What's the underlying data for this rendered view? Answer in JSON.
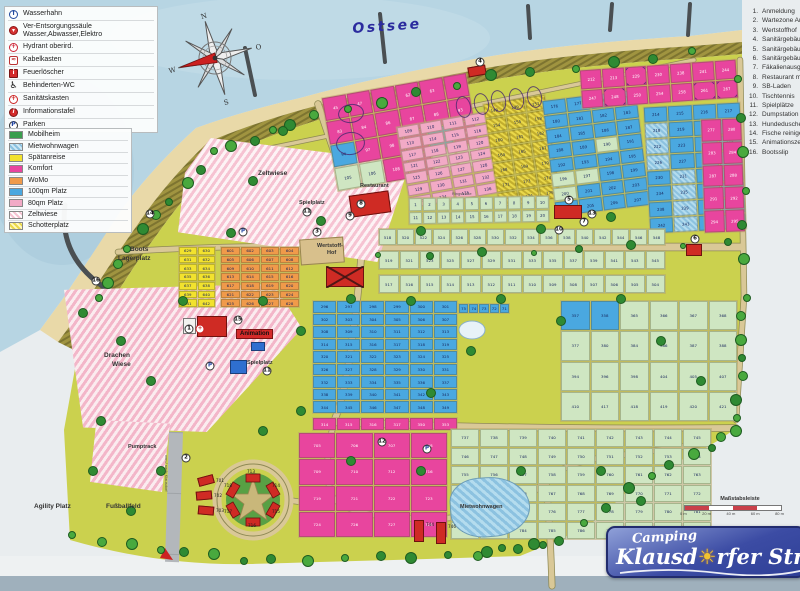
{
  "labels_meta": {
    "sea": "Ostsee"
  },
  "logo": {
    "line1": "Camping",
    "line2_pre": "Klausd",
    "sun_glyph": "☀",
    "line2_post": "rfer Strand"
  },
  "scale": {
    "label": "Maßstabsleiste",
    "ticks": [
      "0 m",
      "20 m",
      "40 m",
      "60 m",
      "80 m"
    ]
  },
  "compass": {
    "n": "N",
    "e": "O",
    "s": "S",
    "w": "W"
  },
  "colors": {
    "sea": "#b7d5e3",
    "beach": "#e9d9a8",
    "dune": "#a09440",
    "ground": "#cbd14e",
    "road": "#d9c897",
    "accent_red": "#cf2b24",
    "logo_blue": "#2e3f96"
  },
  "symbols_legend": [
    {
      "icon": "tap-icon",
      "cls": "ic-tap",
      "glyph": "T",
      "label": "Wasserhahn"
    },
    {
      "icon": "supply-column-icon",
      "cls": "ic-ver",
      "glyph": "▾",
      "label": "Ver-Entsorgungssäule Wasser,Abwasser,Elektro",
      "twoline": true
    },
    {
      "icon": "hydrant-icon",
      "cls": "ic-hyd",
      "glyph": "+",
      "label": "Hydrant oberird."
    },
    {
      "icon": "cable-box-icon",
      "cls": "ic-kab",
      "glyph": "≈",
      "label": "Kabelkasten"
    },
    {
      "icon": "fire-extinguisher-icon",
      "cls": "ic-feu",
      "glyph": "i",
      "label": "Feuerlöscher"
    },
    {
      "icon": "wheelchair-icon",
      "cls": "ic-wc",
      "glyph": "♿",
      "label": "Behinderten-WC"
    },
    {
      "icon": "first-aid-icon",
      "cls": "ic-san",
      "glyph": "+",
      "label": "Sanitätskasten"
    },
    {
      "icon": "info-board-icon",
      "cls": "ic-inf",
      "glyph": "i",
      "label": "Informationstafel"
    },
    {
      "icon": "parking-icon",
      "cls": "ic-park",
      "glyph": "P",
      "label": "Parken"
    }
  ],
  "color_legend": [
    {
      "label": "Mobilheim",
      "css": "solid",
      "hex": "#3a9e4e"
    },
    {
      "label": "Mietwohnwagen",
      "css": "hatch-blue",
      "hex": "#8cc2e0"
    },
    {
      "label": "Spätanreise",
      "css": "solid",
      "hex": "#f2e22e"
    },
    {
      "label": "Komfort",
      "css": "solid",
      "hex": "#e8459e"
    },
    {
      "label": "WoMo",
      "css": "solid",
      "hex": "#f09a4a"
    },
    {
      "label": "100qm Platz",
      "css": "solid",
      "hex": "#4aa8e0"
    },
    {
      "label": "80qm Platz",
      "css": "solid",
      "hex": "#f2aac6"
    },
    {
      "label": "Zeltwiese",
      "css": "hatch-pink",
      "hex": "#f6c3d2"
    },
    {
      "label": "Schotterplatz",
      "css": "hatch-yellow",
      "hex": "#ead84a"
    }
  ],
  "poi_list": [
    {
      "n": "1.",
      "label": "Anmeldung"
    },
    {
      "n": "2.",
      "label": "Wartezone Anreise"
    },
    {
      "n": "3.",
      "label": "Wertstoffhof"
    },
    {
      "n": "4.",
      "label": "Sanitärgebäude"
    },
    {
      "n": "5.",
      "label": "Sanitärgebäude"
    },
    {
      "n": "6.",
      "label": "Sanitärgebäude"
    },
    {
      "n": "7.",
      "label": "Fäkalienausguss"
    },
    {
      "n": "8.",
      "label": "Restaurant mit Imbiss"
    },
    {
      "n": "9.",
      "label": "SB-Laden"
    },
    {
      "n": "10.",
      "label": "Tischtennis"
    },
    {
      "n": "11.",
      "label": "Spielplätze"
    },
    {
      "n": "12.",
      "label": "Dumpstation für Womo"
    },
    {
      "n": "13.",
      "label": "Hundedusche"
    },
    {
      "n": "14.",
      "label": "Fische reinigen"
    },
    {
      "n": "15.",
      "label": "Animationszelt"
    },
    {
      "n": "16.",
      "label": "Bootsslip"
    }
  ],
  "area_labels": [
    {
      "text": "Ostsee",
      "x": 352,
      "y": 22,
      "cls": "lbl-sea",
      "rot": -4
    },
    {
      "text": "Zeltwiese",
      "x": 258,
      "y": 170,
      "cls": "lbl-area"
    },
    {
      "text": "Drachen",
      "x": 104,
      "y": 352,
      "cls": "lbl-area"
    },
    {
      "text": "Wiese",
      "x": 112,
      "y": 361,
      "cls": "lbl-area"
    },
    {
      "text": "Boots",
      "x": 130,
      "y": 246,
      "cls": "lbl-area"
    },
    {
      "text": "Lagerplatz",
      "x": 118,
      "y": 255,
      "cls": "lbl-area"
    },
    {
      "text": "Agility Platz",
      "x": 34,
      "y": 503,
      "cls": "lbl-area"
    },
    {
      "text": "Fußballfeld",
      "x": 106,
      "y": 503,
      "cls": "lbl-area"
    },
    {
      "text": "Pumptrack",
      "x": 128,
      "y": 444,
      "cls": "lbl-area-sm"
    },
    {
      "text": "Restaurant",
      "x": 360,
      "y": 183,
      "cls": "lbl-area-sm"
    },
    {
      "text": "Animation",
      "x": 236,
      "y": 329,
      "cls": "lbl-redbg"
    },
    {
      "text": "Spielplatz",
      "x": 247,
      "y": 360,
      "cls": "lbl-area-sm"
    },
    {
      "text": "Spielplatz",
      "x": 299,
      "y": 200,
      "cls": "lbl-area-sm"
    },
    {
      "text": "Wertstoff-",
      "x": 317,
      "y": 243,
      "cls": "lbl-area-sm"
    },
    {
      "text": "Hof",
      "x": 327,
      "y": 250,
      "cls": "lbl-area-sm"
    },
    {
      "text": "Mietwohnwagen",
      "x": 460,
      "y": 504,
      "cls": "lbl-area-sm"
    },
    {
      "text": "Ringstraße",
      "x": 452,
      "y": 192,
      "cls": "lbl-road"
    },
    {
      "text": "von / nach Klausdorf",
      "x": 168,
      "y": 455,
      "cls": "lbl-road",
      "rot": 90
    },
    {
      "text": "713",
      "x": 247,
      "y": 470,
      "cls": "lbl-plot"
    },
    {
      "text": "714",
      "x": 272,
      "y": 484,
      "cls": "lbl-plot"
    },
    {
      "text": "715",
      "x": 272,
      "y": 510,
      "cls": "lbl-plot"
    },
    {
      "text": "716",
      "x": 248,
      "y": 524,
      "cls": "lbl-plot"
    },
    {
      "text": "717",
      "x": 224,
      "y": 510,
      "cls": "lbl-plot"
    },
    {
      "text": "718",
      "x": 224,
      "y": 484,
      "cls": "lbl-plot"
    }
  ],
  "zones": [
    {
      "name": "spaetanreise-grid",
      "x": 178,
      "y": 246,
      "w": 38,
      "h": 62,
      "rot": 0,
      "cols": 2,
      "rows": 7,
      "cls": "c-yel",
      "nums": {
        "list": [
          629,
          630,
          631,
          632,
          633,
          634,
          635,
          636,
          637,
          638,
          639,
          640,
          641,
          642
        ]
      }
    },
    {
      "name": "womo-grid",
      "x": 220,
      "y": 246,
      "w": 80,
      "h": 62,
      "rot": 0,
      "cols": 4,
      "rows": 7,
      "cls": "c-or",
      "nums": {
        "from": 601,
        "to": 628
      }
    },
    {
      "name": "komfort-top",
      "x": 328,
      "y": 84,
      "w": 148,
      "h": 96,
      "rot": -10,
      "cols": 6,
      "rows": 4,
      "cls": "c-mag",
      "nums": {
        "list": [
          45,
          47,
          61,
          62,
          63,
          82,
          83,
          84,
          86,
          87,
          88,
          93,
          94,
          97,
          98,
          99,
          100,
          104,
          105,
          106,
          108,
          109,
          110,
          111
        ]
      },
      "mixed": {
        "94": "c-blue",
        "100": "c-blue",
        "105": "c-grn",
        "106": "c-grn",
        "110": "c-grn",
        "111": "c-grn"
      }
    },
    {
      "name": "pitch80-grid",
      "x": 402,
      "y": 118,
      "w": 92,
      "h": 84,
      "rot": -10,
      "cols": 4,
      "rows": 7,
      "cls": "c-pink",
      "nums": {
        "from": 109,
        "to": 136
      }
    },
    {
      "name": "schotter-grid",
      "x": 490,
      "y": 98,
      "w": 64,
      "h": 106,
      "rot": -9,
      "cols": 3,
      "rows": 7,
      "cls": "c-schot",
      "nums": {
        "list": [
          148,
          149,
          151,
          154,
          155,
          158,
          160,
          161,
          162,
          164,
          165,
          167,
          168,
          169,
          170,
          171,
          173,
          174,
          175,
          176,
          179
        ]
      }
    },
    {
      "name": "pitch100-a",
      "x": 548,
      "y": 94,
      "w": 96,
      "h": 118,
      "rot": -7,
      "cols": 4,
      "rows": 8,
      "cls": "c-blue",
      "nums": {
        "from": 176,
        "to": 207
      },
      "mixed": {
        "190": "c-grn",
        "196": "c-grn",
        "197": "c-grn",
        "200": "c-grn"
      }
    },
    {
      "name": "komfort-topright",
      "x": 580,
      "y": 64,
      "w": 158,
      "h": 40,
      "rot": -4,
      "cols": 7,
      "rows": 2,
      "cls": "c-mag",
      "nums": {
        "list": [
          212,
          213,
          229,
          230,
          238,
          241,
          244,
          247,
          248,
          250,
          254,
          258,
          261,
          267
        ]
      },
      "circled": [
        229,
        248,
        261,
        267
      ]
    },
    {
      "name": "pitch100-b",
      "x": 646,
      "y": 104,
      "w": 98,
      "h": 128,
      "rot": -3,
      "cols": 4,
      "rows": 8,
      "cls": "c-blue",
      "nums": {
        "from": 214,
        "to": 245
      },
      "mixed": {
        "218": "c-mww",
        "222": "c-mww",
        "226": "c-mww",
        "231": "c-mww",
        "235": "c-mww",
        "239": "c-mww",
        "243": "c-mww"
      }
    },
    {
      "name": "komfort-right",
      "x": 702,
      "y": 118,
      "w": 42,
      "h": 115,
      "rot": -2,
      "cols": 2,
      "rows": 5,
      "cls": "c-mag",
      "nums": {
        "list": [
          277,
          280,
          283,
          284,
          287,
          288,
          291,
          292,
          294,
          295
        ]
      }
    },
    {
      "name": "mobil-row-1-20",
      "x": 408,
      "y": 196,
      "w": 142,
      "h": 28,
      "rot": -1,
      "cols": 10,
      "rows": 2,
      "cls": "c-grn",
      "nums": {
        "from": 1,
        "to": 20
      }
    },
    {
      "name": "mobil-row-518",
      "x": 378,
      "y": 228,
      "w": 288,
      "h": 18,
      "rot": 0,
      "cols": 16,
      "rows": 1,
      "cls": "c-grn",
      "nums": {
        "list": [
          518,
          520,
          522,
          524,
          526,
          528,
          530,
          532,
          534,
          536,
          538,
          540,
          542,
          544,
          546,
          548
        ]
      }
    },
    {
      "name": "mobil-row-519",
      "x": 378,
      "y": 250,
      "w": 288,
      "h": 20,
      "rot": 0,
      "cols": 14,
      "rows": 1,
      "cls": "c-grn",
      "nums": {
        "list": [
          519,
          521,
          523,
          525,
          527,
          529,
          531,
          533,
          535,
          537,
          539,
          541,
          543,
          545
        ]
      }
    },
    {
      "name": "mobil-row-513",
      "x": 378,
      "y": 274,
      "w": 288,
      "h": 20,
      "rot": 0,
      "cols": 14,
      "rows": 1,
      "cls": "c-grn",
      "nums": {
        "list": [
          517,
          516,
          515,
          514,
          513,
          512,
          511,
          510,
          509,
          508,
          507,
          506,
          505,
          504
        ]
      }
    },
    {
      "name": "mobil-right-block",
      "x": 560,
      "y": 300,
      "w": 178,
      "h": 122,
      "rot": 0,
      "cols": 6,
      "rows": 4,
      "cls": "c-grn",
      "nums": {
        "list": [
          357,
          358,
          365,
          366,
          367,
          368,
          377,
          380,
          384,
          386,
          387,
          388,
          394,
          396,
          398,
          404,
          405,
          407,
          410,
          417,
          418,
          419,
          420,
          421
        ]
      },
      "mixed": {
        "357": "c-blue",
        "358": "c-blue"
      }
    },
    {
      "name": "pitch100-center",
      "x": 312,
      "y": 300,
      "w": 146,
      "h": 114,
      "rot": 0,
      "cols": 6,
      "rows": 9,
      "cls": "c-blue",
      "nums": {
        "from": 296,
        "to": 349
      }
    },
    {
      "name": "komfort-center-row",
      "x": 312,
      "y": 417,
      "w": 146,
      "h": 14,
      "rot": 0,
      "cols": 6,
      "rows": 1,
      "cls": "c-mag",
      "nums": {
        "list": [
          314,
          315,
          316,
          317,
          350,
          353
        ]
      }
    },
    {
      "name": "blue-small-row",
      "x": 458,
      "y": 303,
      "w": 52,
      "h": 11,
      "rot": 0,
      "cols": 5,
      "rows": 1,
      "cls": "c-blue",
      "nums": {
        "list": [
          75,
          74,
          73,
          72,
          71
        ]
      }
    },
    {
      "name": "komfort-southwest",
      "x": 298,
      "y": 432,
      "w": 150,
      "h": 106,
      "rot": 0,
      "cols": 4,
      "rows": 4,
      "cls": "c-mag",
      "nums": {
        "list": [
          705,
          706,
          707,
          708,
          709,
          710,
          712,
          716,
          719,
          721,
          722,
          723,
          724,
          726,
          727,
          728
        ]
      }
    },
    {
      "name": "mobil-south",
      "x": 450,
      "y": 428,
      "w": 262,
      "h": 112,
      "rot": 0,
      "cols": 9,
      "rows": 6,
      "cls": "c-grn",
      "nums": {
        "from": 737,
        "to": 790
      }
    }
  ],
  "buildings": [
    {
      "name": "restaurant-building",
      "x": 350,
      "y": 193,
      "w": 40,
      "h": 22,
      "rot": -8,
      "cls": "bld-red"
    },
    {
      "name": "workshop-building-crossed",
      "x": 326,
      "y": 267,
      "w": 38,
      "h": 20,
      "rot": 0,
      "cls": "bld-red"
    },
    {
      "name": "reception-building",
      "x": 183,
      "y": 318,
      "w": 13,
      "h": 16,
      "rot": 0,
      "cls": "bld-white"
    },
    {
      "name": "animation-building",
      "x": 197,
      "y": 316,
      "w": 30,
      "h": 21,
      "rot": 0,
      "cls": "bld-red"
    },
    {
      "name": "sanitary-mid-building",
      "x": 554,
      "y": 205,
      "w": 28,
      "h": 14,
      "rot": 0,
      "cls": "bld-red"
    },
    {
      "name": "sanitary-top-building",
      "x": 468,
      "y": 66,
      "w": 18,
      "h": 10,
      "rot": -10,
      "cls": "bld-red"
    },
    {
      "name": "sanitary-right-building",
      "x": 686,
      "y": 244,
      "w": 16,
      "h": 12,
      "rot": 0,
      "cls": "bld-red"
    },
    {
      "name": "playground-equipment",
      "x": 230,
      "y": 360,
      "w": 17,
      "h": 14,
      "rot": 0,
      "cls": "bld-blue"
    },
    {
      "name": "playground-equipment-2",
      "x": 251,
      "y": 342,
      "w": 14,
      "h": 9,
      "rot": 0,
      "cls": "bld-blue"
    },
    {
      "name": "rental-house",
      "x": 198,
      "y": 476,
      "w": 16,
      "h": 9,
      "rot": -15,
      "cls": "bld-red",
      "label": "701"
    },
    {
      "name": "rental-house",
      "x": 196,
      "y": 491,
      "w": 16,
      "h": 9,
      "rot": -5,
      "cls": "bld-red",
      "label": "702"
    },
    {
      "name": "rental-house",
      "x": 198,
      "y": 506,
      "w": 16,
      "h": 9,
      "rot": 5,
      "cls": "bld-red",
      "label": "703"
    },
    {
      "name": "rental-house",
      "x": 414,
      "y": 520,
      "w": 10,
      "h": 22,
      "rot": 0,
      "cls": "bld-red",
      "label": "744"
    },
    {
      "name": "rental-house",
      "x": 436,
      "y": 522,
      "w": 10,
      "h": 22,
      "rot": 0,
      "cls": "bld-red",
      "label": "746"
    },
    {
      "name": "wertstoffhof-yard",
      "x": 300,
      "y": 238,
      "w": 44,
      "h": 26,
      "rot": -4,
      "cls": "bld-tan"
    }
  ],
  "badges": [
    {
      "n": "1",
      "x": 189,
      "y": 329
    },
    {
      "n": "+",
      "x": 200,
      "y": 329,
      "cls": "b-red"
    },
    {
      "n": "2",
      "x": 186,
      "y": 458
    },
    {
      "n": "3",
      "x": 317,
      "y": 232
    },
    {
      "n": "4",
      "x": 480,
      "y": 62
    },
    {
      "n": "5",
      "x": 569,
      "y": 200
    },
    {
      "n": "6",
      "x": 695,
      "y": 239
    },
    {
      "n": "7",
      "x": 584,
      "y": 222
    },
    {
      "n": "8",
      "x": 361,
      "y": 204
    },
    {
      "n": "9",
      "x": 350,
      "y": 216
    },
    {
      "n": "10",
      "x": 559,
      "y": 230
    },
    {
      "n": "11",
      "x": 267,
      "y": 371
    },
    {
      "n": "11",
      "x": 307,
      "y": 212
    },
    {
      "n": "12",
      "x": 382,
      "y": 442
    },
    {
      "n": "13",
      "x": 592,
      "y": 214
    },
    {
      "n": "14",
      "x": 150,
      "y": 214
    },
    {
      "n": "15",
      "x": 238,
      "y": 320
    },
    {
      "n": "16",
      "x": 96,
      "y": 281
    },
    {
      "n": "P",
      "x": 210,
      "y": 366,
      "cls": "b-p"
    },
    {
      "n": "P",
      "x": 243,
      "y": 232,
      "cls": "b-p"
    },
    {
      "n": "P",
      "x": 427,
      "y": 449,
      "cls": "b-p"
    }
  ],
  "pen_marks": [
    {
      "t": "o",
      "x": 456,
      "y": 96,
      "w": 13,
      "h": 20,
      "r": -12
    },
    {
      "t": "o",
      "x": 474,
      "y": 93,
      "w": 13,
      "h": 20,
      "r": -12
    },
    {
      "t": "o",
      "x": 491,
      "y": 90,
      "w": 13,
      "h": 20,
      "r": -12
    },
    {
      "t": "o",
      "x": 509,
      "y": 88,
      "w": 13,
      "h": 20,
      "r": -12
    },
    {
      "t": "o",
      "x": 527,
      "y": 86,
      "w": 13,
      "h": 20,
      "r": -12
    },
    {
      "t": "o",
      "x": 338,
      "y": 104,
      "w": 24,
      "h": 17,
      "r": -8
    },
    {
      "t": "o",
      "x": 336,
      "y": 132,
      "w": 27,
      "h": 21,
      "r": -8
    },
    {
      "t": "x",
      "x": 326,
      "y": 266,
      "w": 38,
      "h": 22
    }
  ]
}
